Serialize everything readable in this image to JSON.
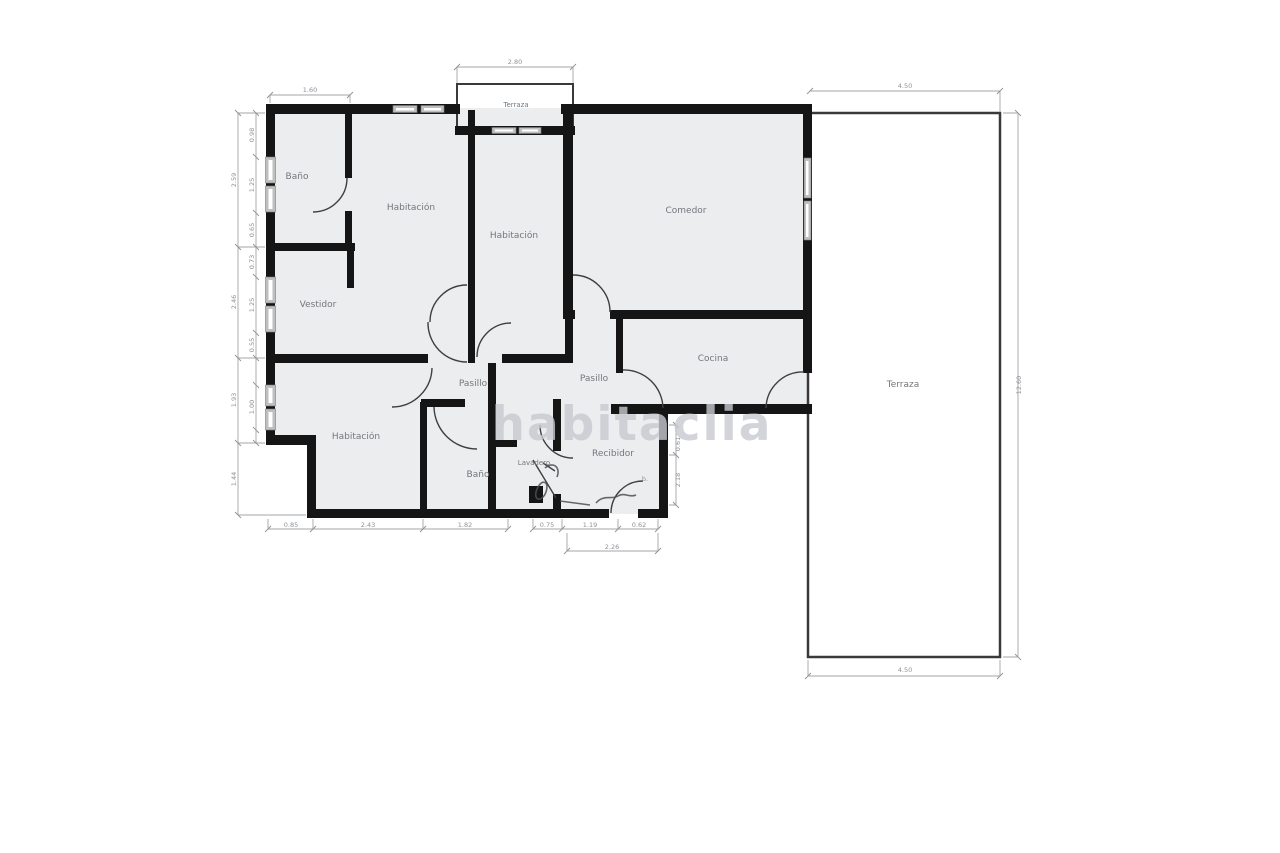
{
  "watermark": "habitaclia",
  "rooms": {
    "terraza_balcon": "Terraza",
    "bano1": "Baño",
    "habitacion1": "Habitación",
    "habitacion2": "Habitación",
    "comedor": "Comedor",
    "vestidor": "Vestidor",
    "pasillo1": "Pasillo",
    "pasillo2": "Pasillo",
    "cocina": "Cocina",
    "habitacion3": "Habitación",
    "bano2": "Baño",
    "lavadero": "Lavadero",
    "recibidor": "Recibidor",
    "terraza": "Terraza",
    "b_mark": "b."
  },
  "dims": {
    "top_left": "1.60",
    "balcony": "2.80",
    "terrace_top": "4.50",
    "terrace_bottom": "4.50",
    "terrace_right": "12.60",
    "left_outer": [
      "2.59",
      "2.46",
      "1.93",
      "1.44"
    ],
    "left_inner": [
      "0.98",
      "1.25",
      "0.65",
      "0.73",
      "1.25",
      "0.55",
      "1.00"
    ],
    "bottom": [
      "0.85",
      "2.43",
      "1.82",
      "0.75",
      "1.19",
      "0.62"
    ],
    "bottom_total": "2.26",
    "entry_side": [
      "0.61",
      "2.18"
    ]
  }
}
